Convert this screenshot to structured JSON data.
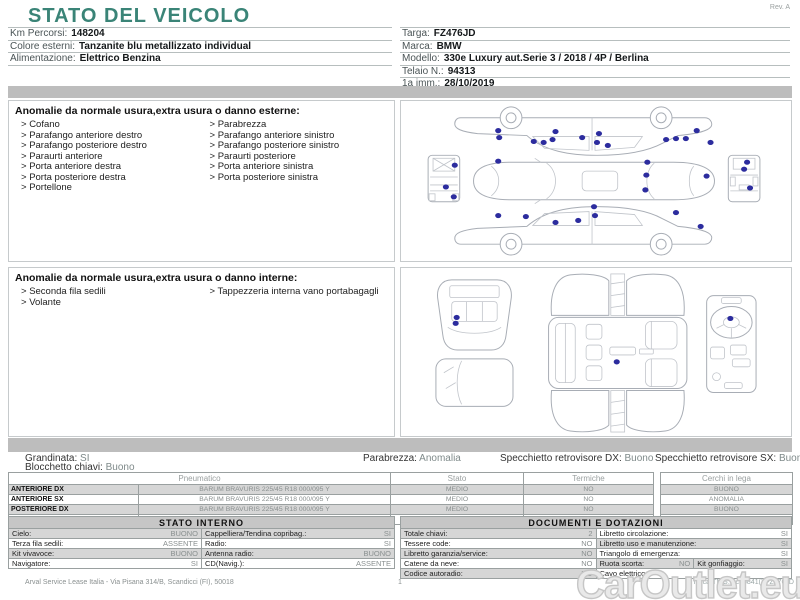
{
  "meta": {
    "rev": "Rev. A",
    "page": "1"
  },
  "title": "STATO DEL VEICOLO",
  "header": {
    "left": [
      {
        "label": "Km Percorsi:",
        "value": "148204"
      },
      {
        "label": "Colore esterni:",
        "value": "Tanzanite blu metallizzato individual"
      },
      {
        "label": "Alimentazione:",
        "value": "Elettrico Benzina"
      }
    ],
    "right": [
      {
        "label": "Targa:",
        "value": "FZ476JD"
      },
      {
        "label": "Marca:",
        "value": "BMW"
      },
      {
        "label": "Modello:",
        "value": "330e Luxury aut.Serie 3 / 2018 / 4P / Berlina"
      },
      {
        "label": "Telaio N.:",
        "value": "94313"
      },
      {
        "label": "1a imm.:",
        "value": "28/10/2019"
      }
    ]
  },
  "exterior": {
    "title": "Anomalie da normale usura,extra usura o danno esterne:",
    "items_col1": [
      "Cofano",
      "Parafango anteriore destro",
      "Parafango posteriore destro",
      "Paraurti anteriore",
      "Porta anteriore destra",
      "Porta posteriore destra",
      "Portellone"
    ],
    "items_col2": [
      "Parabrezza",
      "Parafango anteriore sinistro",
      "Parafango posteriore sinistro",
      "Paraurti posteriore",
      "Porta anteriore sinistra",
      "Porta posteriore sinistra"
    ]
  },
  "interior": {
    "title": "Anomalie da normale usura,extra usura o danno interne:",
    "items_col1": [
      "Seconda fila sedili",
      "Volante"
    ],
    "items_col2": [
      "Tappezzeria interna vano portabagagli"
    ]
  },
  "conditions": {
    "grandinata": {
      "label": "Grandinata:",
      "value": "SI"
    },
    "parabrezza": {
      "label": "Parabrezza:",
      "value": "Anomalia"
    },
    "specchietto_dx": {
      "label": "Specchietto retrovisore DX:",
      "value": "Buono"
    },
    "specchietto_sx": {
      "label": "Specchietto retrovisore SX:",
      "value": "Buono"
    },
    "blocchetto": {
      "label": "Blocchetto chiavi:",
      "value": "Buono"
    }
  },
  "tyres": {
    "headers": [
      "Pneumatico",
      "Stato",
      "Termiche",
      "Cerchi in lega"
    ],
    "rows": [
      {
        "pos": "ANTERIORE DX",
        "tyre": "BARUM BRAVURIS  225/45 R18 000/095 Y",
        "stato": "MEDIO",
        "termiche": "NO",
        "cerchi": "BUONO"
      },
      {
        "pos": "ANTERIORE SX",
        "tyre": "BARUM BRAVURIS  225/45 R18 000/095 Y",
        "stato": "MEDIO",
        "termiche": "NO",
        "cerchi": "ANOMALIA"
      },
      {
        "pos": "POSTERIORE DX",
        "tyre": "BARUM BRAVURIS  225/45 R18 000/095 Y",
        "stato": "MEDIO",
        "termiche": "NO",
        "cerchi": "BUONO"
      },
      {
        "pos": "POSTERIORE SX",
        "tyre": "BARUM BRAVURIS  225/45 R18 000/095 Y",
        "stato": "MEDIO",
        "termiche": "NO",
        "cerchi": "ANOMALIA"
      }
    ]
  },
  "stato_interno": {
    "title": "STATO INTERNO",
    "rows": [
      {
        "left": [
          {
            "label": "Cielo:",
            "value": "BUONO"
          }
        ],
        "right": [
          {
            "label": "Cappelliera/Tendina copribag.:",
            "value": "SI"
          }
        ]
      },
      {
        "left": [
          {
            "label": "Terza fila sedili:",
            "value": "ASSENTE"
          }
        ],
        "right": [
          {
            "label": "Radio:",
            "value": "SI"
          }
        ]
      },
      {
        "left": [
          {
            "label": "Kit vivavoce:",
            "value": "BUONO"
          }
        ],
        "right": [
          {
            "label": "Antenna radio:",
            "value": "BUONO"
          }
        ]
      },
      {
        "left": [
          {
            "label": "Navigatore:",
            "value": "SI"
          }
        ],
        "right": [
          {
            "label": "CD(Navig.):",
            "value": "ASSENTE"
          }
        ]
      }
    ]
  },
  "documenti": {
    "title": "DOCUMENTI E DOTAZIONI",
    "rows": [
      {
        "left": [
          {
            "label": "Totale chiavi:",
            "value": "2"
          }
        ],
        "right": [
          {
            "label": "Libretto circolazione:",
            "value": "SI"
          }
        ]
      },
      {
        "left": [
          {
            "label": "Tessere code:",
            "value": "NO"
          }
        ],
        "right": [
          {
            "label": "Libretto uso e manutenzione:",
            "value": "SI"
          }
        ]
      },
      {
        "left": [
          {
            "label": "Libretto garanzia/service:",
            "value": "NO"
          }
        ],
        "right": [
          {
            "label": "Triangolo di emergenza:",
            "value": "SI"
          }
        ]
      },
      {
        "left": [
          {
            "label": "Catene da neve:",
            "value": "NO"
          }
        ],
        "right": [
          {
            "label": "Ruota scorta:",
            "value": "NO"
          },
          {
            "label": "Kit gonfiaggio:",
            "value": "SI"
          }
        ]
      },
      {
        "left": [
          {
            "label": "Codice autoradio:",
            "value": "NO"
          }
        ],
        "right": [
          {
            "label": "Cavo elettrico:",
            "value": ""
          }
        ]
      }
    ]
  },
  "damage_dots": {
    "exterior": [
      [
        97,
        30
      ],
      [
        98,
        37
      ],
      [
        133,
        41
      ],
      [
        143,
        42
      ],
      [
        152,
        39
      ],
      [
        155,
        31
      ],
      [
        182,
        37
      ],
      [
        199,
        33
      ],
      [
        197,
        42
      ],
      [
        208,
        45
      ],
      [
        267,
        39
      ],
      [
        277,
        38
      ],
      [
        287,
        38
      ],
      [
        298,
        30
      ],
      [
        312,
        42
      ],
      [
        97,
        61
      ],
      [
        248,
        62
      ],
      [
        247,
        75
      ],
      [
        308,
        76
      ],
      [
        246,
        90
      ],
      [
        97,
        116
      ],
      [
        125,
        117
      ],
      [
        155,
        123
      ],
      [
        178,
        121
      ],
      [
        195,
        116
      ],
      [
        194,
        107
      ],
      [
        277,
        113
      ],
      [
        302,
        127
      ],
      [
        53,
        65
      ],
      [
        44,
        87
      ],
      [
        52,
        97
      ],
      [
        349,
        62
      ],
      [
        346,
        69
      ],
      [
        352,
        88
      ]
    ],
    "interior": [
      [
        55,
        50
      ],
      [
        54,
        56
      ],
      [
        217,
        95
      ],
      [
        332,
        51
      ]
    ]
  },
  "footer": {
    "left": "Arval Service Lease Italia - Via Pisana 314/B, Scandicci (FI), 50018",
    "right": "ID carTMG: 3ca6841() FZ476JD"
  },
  "watermark": "CarOutlet.eu",
  "colors": {
    "accent_teal": "#3a8477",
    "band_gray": "#bdbdbd",
    "dot_blue": "#2c2c9e",
    "row_shade": "#d6d6d6"
  }
}
